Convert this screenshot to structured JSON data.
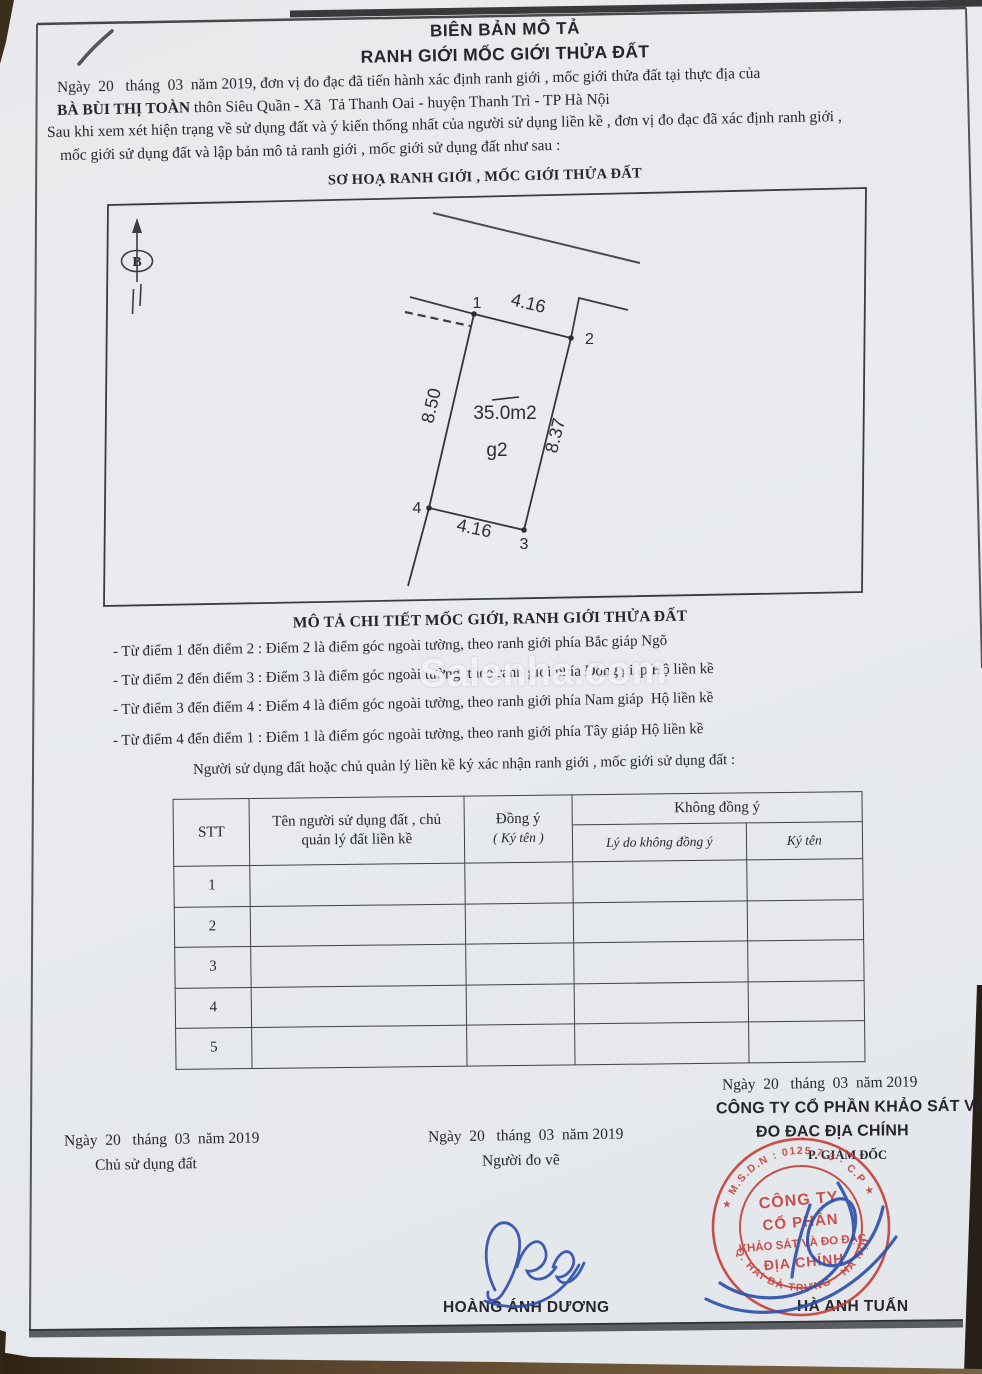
{
  "document": {
    "title_line1": "BIÊN BẢN MÔ TẢ",
    "title_line2": "RANH GIỚI MỐC GIỚI THỬA ĐẤT",
    "intro": {
      "line1": "Ngày  20   tháng  03  năm 2019, đơn vị đo đạc đã tiến hành xác định ranh giới , mốc giới thửa đất tại thực địa của",
      "owner": "BÀ BÙI THỊ TOÀN",
      "line2_rest": " thôn Siêu Quần - Xã  Tả Thanh Oai - huyện Thanh Trì - TP Hà Nội",
      "line3": "Sau khi xem xét hiện trạng về sử dụng đất và ý kiến thống nhất của người sử dụng liền kề , đơn vị đo đạc đã xác định ranh giới ,",
      "line4": "mốc giới sử dụng đất và lập bản mô tả ranh giới , mốc giới sử dụng đất như sau :"
    },
    "sketch": {
      "caption": "SƠ HOẠ RANH GIỚI , MỐC GIỚI THỬA ĐẤT",
      "north_label": "B",
      "area_label": "35.0m2",
      "parcel_label": "g2",
      "edges": {
        "top": "4.16",
        "right": "8.37",
        "bottom": "4.16",
        "left": "8.50"
      },
      "points": [
        "1",
        "2",
        "3",
        "4"
      ]
    },
    "detail": {
      "heading": "MÔ TẢ CHI TIẾT MỐC GIỚI, RANH GIỚI THỬA ĐẤT",
      "items": [
        "- Từ điểm 1 đến điểm 2 : Điểm 2 là điểm góc ngoài tường, theo ranh giới phía Bắc giáp Ngõ",
        "- Từ điểm 2 đến điểm 3 : Điểm 3 là điểm góc ngoài tường, theo ranh giới phía Đông giáp Hộ liền kề",
        "- Từ điểm 3 đến điểm 4 : Điểm 4 là điểm góc ngoài tường, theo ranh giới phía Nam giáp  Hộ liền kề",
        "- Từ điểm 4 đến điểm 1 : Điểm 1 là điểm góc ngoài tường, theo ranh giới phía Tây giáp Hộ liền kề"
      ],
      "closing": "Người sử dụng đất hoặc chủ quản lý liền kề ký xác nhận ranh giới , mốc giới sử dụng đất :"
    },
    "table": {
      "col_stt": "STT",
      "col_name_line1": "Tên người sử dụng đất , chủ",
      "col_name_line2": "quản lý đất liền kề",
      "col_agree_line1": "Đồng ý",
      "col_agree_line2": "( Ký tên )",
      "col_disagree": "Không đồng ý",
      "col_reason": "Lý do không đồng ý",
      "col_sign": "Ký tên",
      "rows": [
        "1",
        "2",
        "3",
        "4",
        "5"
      ]
    },
    "signatures": {
      "left": {
        "date": "Ngày  20   tháng  03  năm 2019",
        "role": "Chủ sử dụng đất"
      },
      "middle": {
        "date": "Ngày  20   tháng  03  năm 2019",
        "role": "Người đo vẽ",
        "name": "HOÀNG ÁNH DƯƠNG"
      },
      "right": {
        "date": "Ngày  20   tháng  03  năm 2019",
        "company_line1": "CÔNG TY CỔ PHẦN KHẢO SÁT VÀ",
        "company_line2": "ĐO ĐẠC ĐỊA CHÍNH",
        "role": "P. GIÁM ĐỐC",
        "name": "HÀ ANH TUẤN"
      }
    },
    "stamp": {
      "ring_top": "★ M.S.D.N : 0125.7.3 · C.P ★",
      "ring_bottom": "Q. HAI BÀ TRƯNG · HÀ NỘI",
      "center_line1": "CÔNG TY",
      "center_line2": "CỔ PHẦN",
      "center_line3": "KHẢO SÁT VÀ ĐO ĐẠC",
      "center_line4": "ĐỊA CHÍNH"
    },
    "watermark": "Salenha.com"
  },
  "colors": {
    "paper": "#e9ebee",
    "ink": "#26262e",
    "stamp_red": "#c53b33",
    "signature_blue": "#2c4fab",
    "wood_dark": "#3c2e1d"
  }
}
